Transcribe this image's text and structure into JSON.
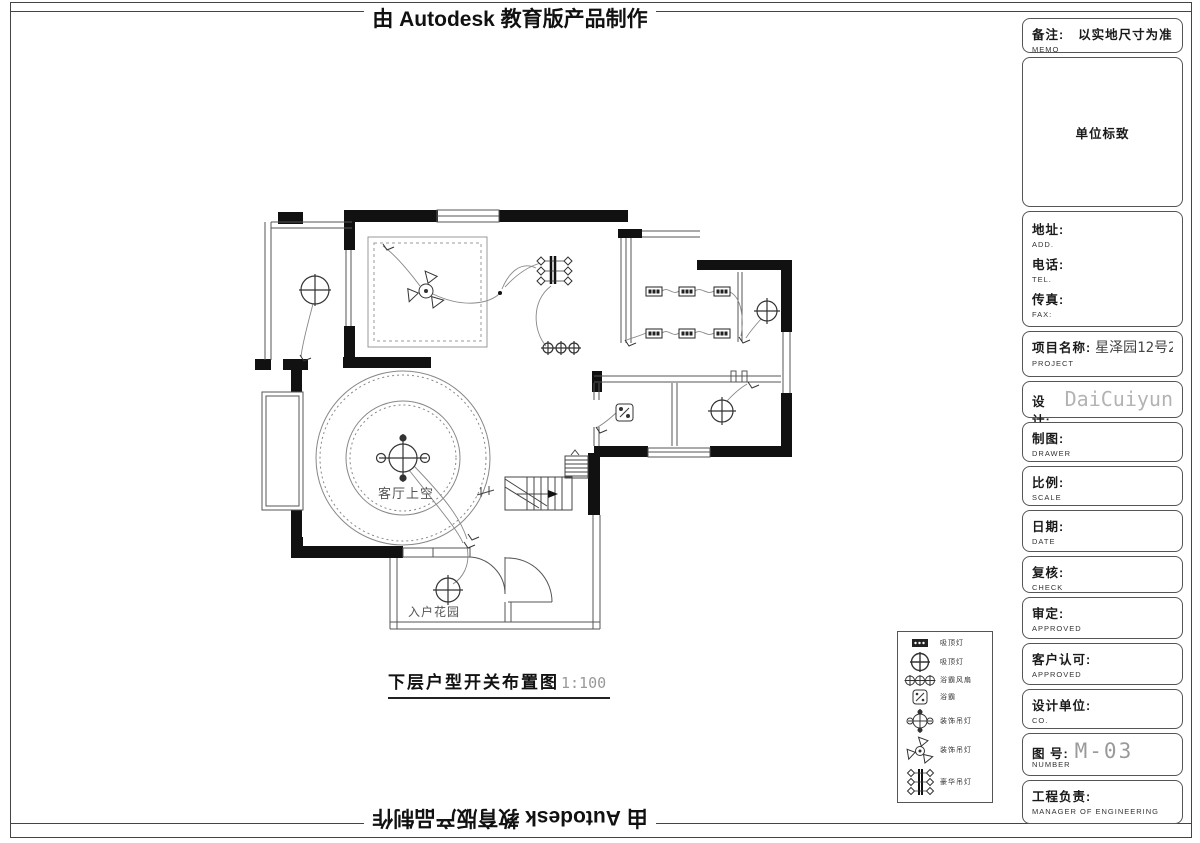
{
  "page": {
    "top_banner": "由 Autodesk 教育版产品制作",
    "bottom_banner": "由 Autodesk 教育版产品制作"
  },
  "drawing": {
    "title": "下层户型开关布置图",
    "scale": "1:100",
    "labels": {
      "living_void": "客厅上空",
      "entry_garden": "入户花园"
    }
  },
  "legend": {
    "items": [
      {
        "symbol": "track-light",
        "label": "吸顶灯"
      },
      {
        "symbol": "ceiling-lamp",
        "label": "吸顶灯"
      },
      {
        "symbol": "downlight-row",
        "label": "浴霸风扇"
      },
      {
        "symbol": "bath-heater",
        "label": "浴霸"
      },
      {
        "symbol": "pendant-lamp",
        "label": "装饰吊灯"
      },
      {
        "symbol": "fan-lamp",
        "label": "装饰吊灯"
      },
      {
        "symbol": "chandelier",
        "label": "豪华吊灯"
      }
    ]
  },
  "titleblock": {
    "memo": {
      "label": "备注:",
      "sub": "MEMO",
      "value": "以实地尺寸为准"
    },
    "logo": "单位标致",
    "address": {
      "label": "地址:",
      "sub": "ADD."
    },
    "tel": {
      "label": "电话:",
      "sub": "TEL."
    },
    "fax": {
      "label": "传真:",
      "sub": "FAX:"
    },
    "project": {
      "label": "项目名称:",
      "sub": "PROJECT",
      "value": "星泽园12号2-303--"
    },
    "designer": {
      "label": "设计:",
      "sub": "DESIGNER",
      "value": "DaiCuiyun"
    },
    "drawer": {
      "label": "制图:",
      "sub": "DRAWER"
    },
    "scale": {
      "label": "比例:",
      "sub": "SCALE"
    },
    "date": {
      "label": "日期:",
      "sub": "DATE"
    },
    "check": {
      "label": "复核:",
      "sub": "CHECK"
    },
    "approved": {
      "label": "审定:",
      "sub": "APPROVED"
    },
    "client": {
      "label": "客户认可:",
      "sub": "APPROVED"
    },
    "company": {
      "label": "设计单位:",
      "sub": "CO."
    },
    "number": {
      "label": "图 号:",
      "sub": "NUMBER",
      "value": "M-03"
    },
    "manager": {
      "label": "工程负责:",
      "sub": "MANAGER OF ENGINEERING"
    }
  },
  "colors": {
    "wall": "#111111",
    "line": "#555555",
    "wire": "#888888",
    "cad_gray": "#b3b3b3"
  }
}
